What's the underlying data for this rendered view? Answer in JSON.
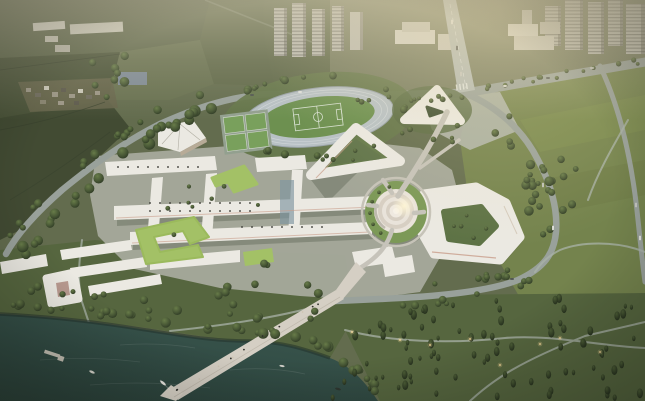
{
  "scene": {
    "type": "aerial-architectural-rendering",
    "setting": "bird's-eye dusk rendering of a lakeside campus masterplan ringed by a loop road, with city apartment towers along the top, farmland at upper left, a central spiral hub building, courtyard buildings, a running track, dormitories and a long pier into a dark lake",
    "palette": {
      "ground_base": "#636c4e",
      "farmland_dark": "#424b33",
      "farmland_mid": "#4a5339",
      "farmland_light": "#677050",
      "city_ground": "#767b5f",
      "tower_light": "#bdbcb2",
      "tower_shadow": "#8f8e84",
      "road": "#99a19b",
      "avenue": "#b3bab6",
      "plaza": "#a6aa9c",
      "roof_white": "#ebe9e2",
      "roof_shadow": "#c2bcb0",
      "facade_accent": "#c99e8b",
      "green_roof": "#a3c166",
      "hub_green": "#7c9957",
      "track": "#b8c1c5",
      "pitch": "#6d9050",
      "court": "#79a05c",
      "lawn": "#74834d",
      "park_grass": "#56663f",
      "tree_light": "#687c49",
      "tree_dark": "#2b3622",
      "water": "#3a574f",
      "water_deep": "#2b423b",
      "pier": "#d5cfc4",
      "haze": "#d6cdb2"
    },
    "landmarks": [
      "apartment-towers",
      "city-cross-road",
      "main-avenue",
      "entrance-plaza",
      "entrance-triangle-building",
      "running-track",
      "soccer-pitch",
      "sports-courts",
      "auditorium-building",
      "v-shaped-building",
      "spiral-hub-building",
      "courtyard-ring-building",
      "academic-quad-bars",
      "green-roof-buildings",
      "dormitory-rows",
      "d-shaped-dormitory",
      "pedestrian-axis",
      "lake-pier",
      "boat-dock",
      "sailboats",
      "lake",
      "farmland",
      "village",
      "greenhouses",
      "forest-park",
      "east-lawn",
      "street-trees"
    ]
  }
}
